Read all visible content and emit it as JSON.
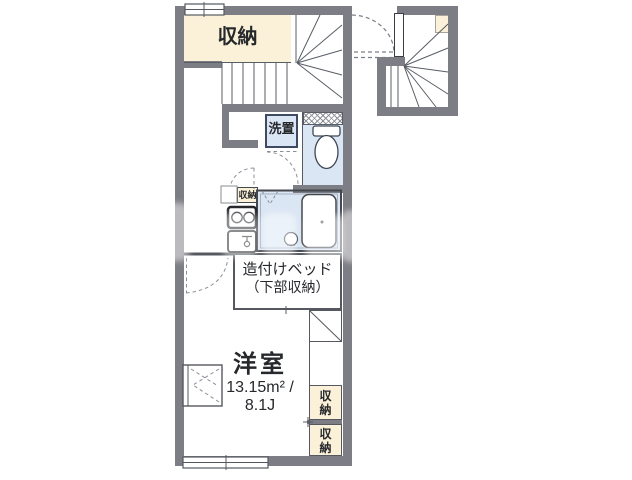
{
  "floorplan": {
    "labels": {
      "storage_top": "収納",
      "washer": "洗置",
      "kitchen_storage": "収納",
      "bed_line1": "造付けベッド",
      "bed_line2": "（下部収納）",
      "room_name": "洋室",
      "room_area": "13.15m² /",
      "room_size": "8.1J",
      "closet_upper": "収納",
      "closet_lower": "収納"
    },
    "colors": {
      "wall": "#7d7d85",
      "storage_fill": "#fbf1d8",
      "wet_area_fill": "#dbe6f4",
      "line": "#55595f",
      "background": "#ffffff"
    }
  }
}
